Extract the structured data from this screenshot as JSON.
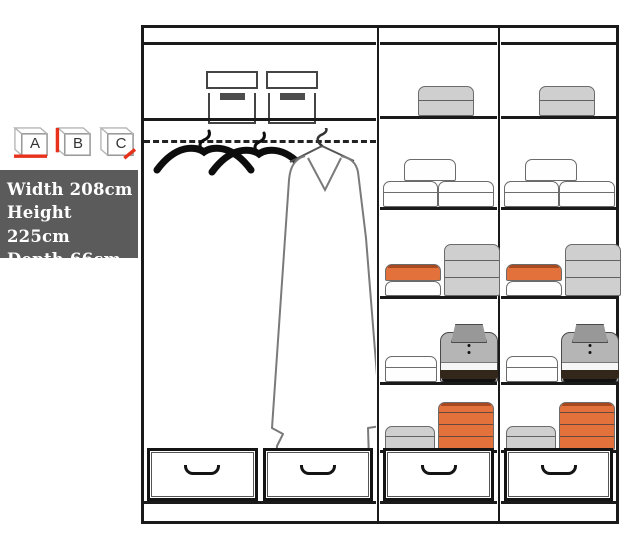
{
  "info_panel": {
    "cubes": [
      {
        "label": "A",
        "accent": "bottom"
      },
      {
        "label": "B",
        "accent": "left"
      },
      {
        "label": "C",
        "accent": "corner"
      }
    ],
    "dimensions": [
      "Width 208cm",
      "Height 225cm",
      "Depth 66cm"
    ],
    "panel_bg": "#5b5b5b",
    "accent_red": "#e8311a"
  },
  "colors": {
    "white": "#fefefe",
    "gray": "#cfcfcf",
    "orange": "#e2713c",
    "line": "#1a1a1a"
  },
  "wardrobe": {
    "left_section": {
      "storage_boxes": 2,
      "hangers": 2,
      "garment": "long-coat-on-hanger",
      "drawers": 2
    },
    "shelf_template": [
      {
        "h": 71,
        "items": [
          {
            "k": "folded",
            "color": "gray",
            "x": 38,
            "w": 56,
            "h": 30,
            "seams": [
              0.45
            ]
          }
        ]
      },
      {
        "h": 88,
        "items": [
          {
            "k": "folded",
            "color": "white",
            "x": 3,
            "w": 55,
            "h": 26,
            "seams": [
              0.5
            ]
          },
          {
            "k": "folded",
            "color": "white",
            "x": 58,
            "w": 56,
            "h": 26,
            "seams": [
              0.5
            ]
          },
          {
            "k": "folded",
            "color": "white",
            "x": 24,
            "w": 52,
            "h": 22,
            "seams": [],
            "dy": 26
          }
        ]
      },
      {
        "h": 86,
        "items": [
          {
            "k": "folded",
            "color": "white",
            "x": 5,
            "w": 56,
            "h": 15,
            "seams": []
          },
          {
            "k": "folded",
            "color": "orange",
            "x": 5,
            "w": 56,
            "h": 17,
            "seams": [],
            "dy": 15,
            "topEdge": true
          },
          {
            "k": "folded",
            "color": "gray",
            "x": 64,
            "w": 56,
            "h": 52,
            "seams": [
              0.33,
              0.66
            ]
          }
        ]
      },
      {
        "h": 83,
        "items": [
          {
            "k": "folded",
            "color": "white",
            "x": 5,
            "w": 52,
            "h": 26,
            "seams": [
              0.5
            ]
          },
          {
            "k": "polo",
            "x": 60,
            "w": 58,
            "h": 58
          }
        ]
      },
      {
        "h": 65,
        "items": [
          {
            "k": "folded",
            "color": "gray",
            "x": 5,
            "w": 50,
            "h": 24,
            "seams": [
              0.5
            ]
          },
          {
            "k": "folded",
            "color": "orange",
            "x": 58,
            "w": 56,
            "h": 48,
            "seams": [
              0.25,
              0.5,
              0.75
            ],
            "topEdge": true
          }
        ]
      }
    ],
    "columns": [
      {
        "id": "middle",
        "use_template": true,
        "drawers": 1
      },
      {
        "id": "right",
        "use_template": true,
        "drawers": 1
      }
    ]
  }
}
